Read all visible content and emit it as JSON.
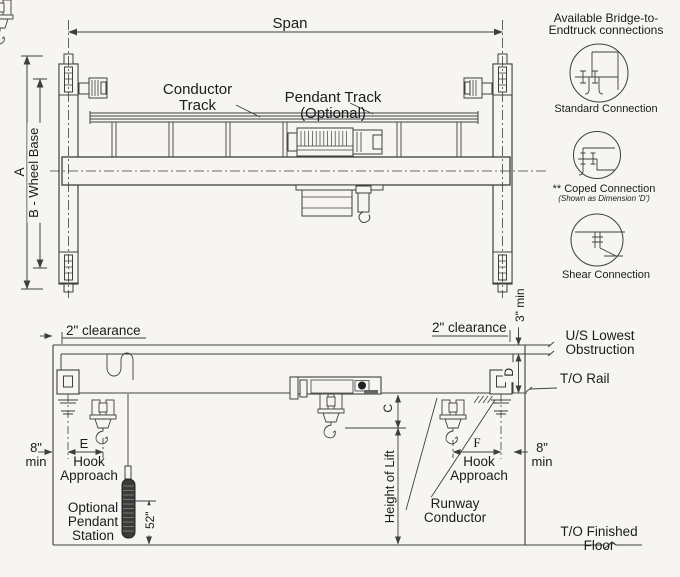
{
  "top_view": {
    "span": "Span",
    "dim_a": "A",
    "dim_b": "B - Wheel Base",
    "conductor_track_line1": "Conductor",
    "conductor_track_line2": "Track",
    "pendant_track_line1": "Pendant Track",
    "pendant_track_line2": "(Optional)"
  },
  "legend": {
    "title_line1": "Available Bridge-to-",
    "title_line2": "Endtruck connections",
    "items": [
      {
        "label": "Standard Connection",
        "sublabel": ""
      },
      {
        "label": "** Coped Connection",
        "sublabel": "(Shown as Dimension 'D')"
      },
      {
        "label": "Shear Connection",
        "sublabel": ""
      }
    ]
  },
  "elevation": {
    "clearance_left": "2\" clearance",
    "clearance_right": "2\" clearance",
    "three_min": "3\" min",
    "us_lowest_line1": "U/S Lowest",
    "us_lowest_line2": "Obstruction",
    "to_rail": "T/O Rail",
    "dim_d": "D",
    "dim_c": "C",
    "dim_e": "E",
    "dim_f": "F",
    "eight_min_left_line1": "8\"",
    "eight_min_left_line2": "min",
    "eight_min_right_line1": "8\"",
    "eight_min_right_line2": "min",
    "hook_approach_left_line1": "Hook",
    "hook_approach_left_line2": "Approach",
    "hook_approach_right_line1": "Hook",
    "hook_approach_right_line2": "Approach",
    "height_of_lift": "Height of Lift",
    "runway_conductor_line1": "Runway",
    "runway_conductor_line2": "Conductor",
    "pendant_station_line1": "Optional",
    "pendant_station_line2": "Pendant",
    "pendant_station_line3": "Station",
    "fifty_two": "52\"",
    "floor_line1": "T/O Finished",
    "floor_line2": "Floor"
  }
}
